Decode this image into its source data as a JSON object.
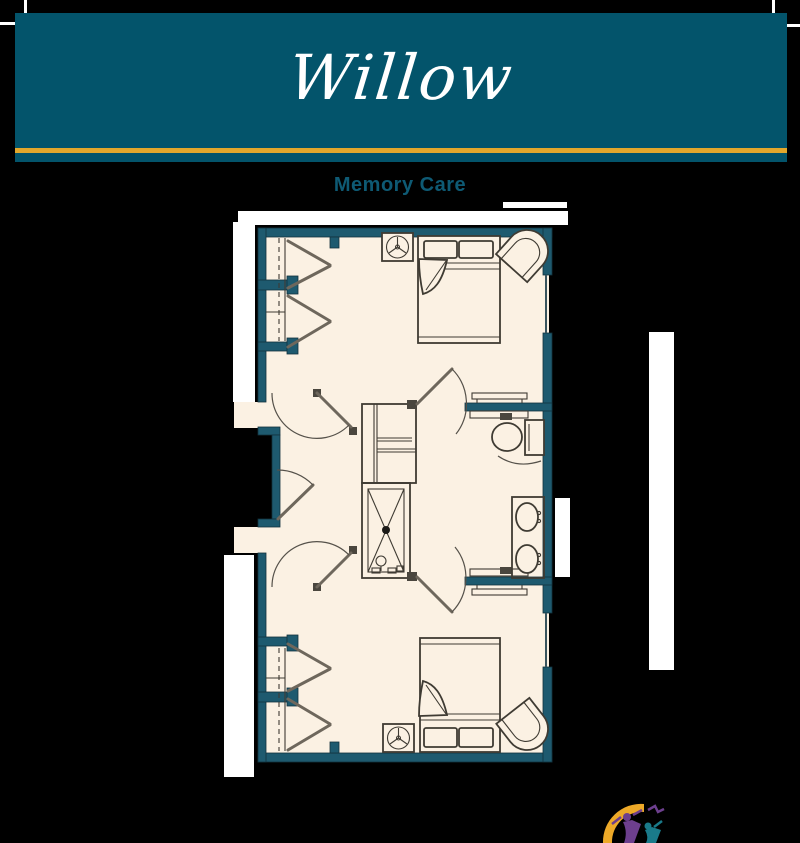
{
  "header": {
    "title": "Willow"
  },
  "plan": {
    "label": "Memory Care"
  },
  "theme": {
    "background": "#000000",
    "banner": "#03546b",
    "gold": "#e2a72c",
    "label_color": "#0e5a74",
    "wall": "#1e5a6f",
    "floor": "#fbf1e3",
    "line": "#3f3b33",
    "logo_gold": "#eda928",
    "logo_purple": "#6d3f8e",
    "logo_teal": "#1a7a8a"
  }
}
